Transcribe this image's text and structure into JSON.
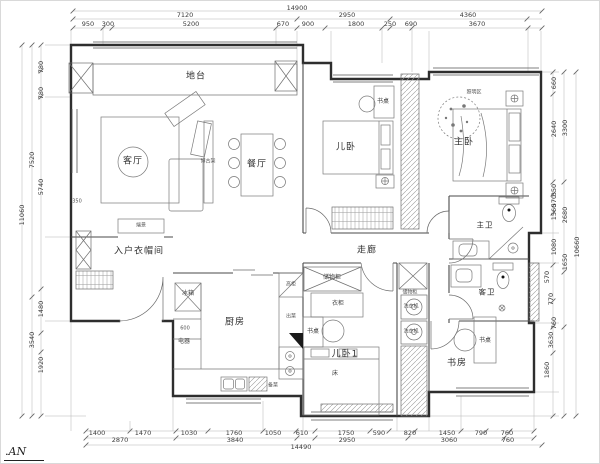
{
  "meta": {
    "drawing_type": "residential floor plan"
  },
  "footer": {
    "text": ".AN"
  },
  "colors": {
    "wall": "#2e2e2e",
    "partition": "#4a4a4a",
    "furniture": "#7a7a7a",
    "dim_line": "#b5b5b5",
    "dim_text": "#3a3a3a",
    "bg": "#ffffff"
  },
  "dimension_labels": {
    "top": [
      {
        "text": "14900",
        "x": 296,
        "y": 7
      },
      {
        "text": "7120",
        "x": 184,
        "y": 14
      },
      {
        "text": "2950",
        "x": 346,
        "y": 14
      },
      {
        "text": "4360",
        "x": 467,
        "y": 14
      },
      {
        "text": "950",
        "x": 87,
        "y": 23
      },
      {
        "text": "300",
        "x": 107,
        "y": 23
      },
      {
        "text": "5200",
        "x": 190,
        "y": 23
      },
      {
        "text": "670",
        "x": 282,
        "y": 23
      },
      {
        "text": "900",
        "x": 307,
        "y": 23
      },
      {
        "text": "1800",
        "x": 355,
        "y": 23
      },
      {
        "text": "250",
        "x": 389,
        "y": 23
      },
      {
        "text": "690",
        "x": 410,
        "y": 23
      },
      {
        "text": "3670",
        "x": 476,
        "y": 23
      }
    ],
    "bottom": [
      {
        "text": "1400",
        "x": 96,
        "y": 432
      },
      {
        "text": "1470",
        "x": 142,
        "y": 432
      },
      {
        "text": "1030",
        "x": 188,
        "y": 432
      },
      {
        "text": "1760",
        "x": 233,
        "y": 432
      },
      {
        "text": "1050",
        "x": 272,
        "y": 432
      },
      {
        "text": "610",
        "x": 301,
        "y": 432
      },
      {
        "text": "1750",
        "x": 345,
        "y": 432
      },
      {
        "text": "590",
        "x": 378,
        "y": 432
      },
      {
        "text": "820",
        "x": 409,
        "y": 432
      },
      {
        "text": "1450",
        "x": 446,
        "y": 432
      },
      {
        "text": "790",
        "x": 480,
        "y": 432
      },
      {
        "text": "760",
        "x": 506,
        "y": 432
      },
      {
        "text": "2870",
        "x": 119,
        "y": 439
      },
      {
        "text": "3840",
        "x": 234,
        "y": 439
      },
      {
        "text": "2950",
        "x": 346,
        "y": 439
      },
      {
        "text": "3060",
        "x": 448,
        "y": 439
      },
      {
        "text": "760",
        "x": 507,
        "y": 439
      },
      {
        "text": "14490",
        "x": 300,
        "y": 446
      }
    ],
    "left": [
      {
        "text": "780",
        "x": 40,
        "y": 66
      },
      {
        "text": "780",
        "x": 40,
        "y": 92
      },
      {
        "text": "7520",
        "x": 31,
        "y": 159
      },
      {
        "text": "5740",
        "x": 40,
        "y": 186
      },
      {
        "text": "11060",
        "x": 21,
        "y": 214
      },
      {
        "text": "1480",
        "x": 40,
        "y": 308
      },
      {
        "text": "3540",
        "x": 31,
        "y": 339
      },
      {
        "text": "1920",
        "x": 40,
        "y": 364
      }
    ],
    "right": [
      {
        "text": "660",
        "x": 553,
        "y": 82
      },
      {
        "text": "2640",
        "x": 553,
        "y": 128
      },
      {
        "text": "3300",
        "x": 564,
        "y": 127
      },
      {
        "text": "350",
        "x": 553,
        "y": 189
      },
      {
        "text": "570",
        "x": 553,
        "y": 200
      },
      {
        "text": "1560",
        "x": 553,
        "y": 211
      },
      {
        "text": "2680",
        "x": 564,
        "y": 214
      },
      {
        "text": "1080",
        "x": 553,
        "y": 246
      },
      {
        "text": "1650",
        "x": 564,
        "y": 261
      },
      {
        "text": "10660",
        "x": 576,
        "y": 246
      },
      {
        "text": "570",
        "x": 546,
        "y": 276
      },
      {
        "text": "770",
        "x": 550,
        "y": 298
      },
      {
        "text": "760",
        "x": 553,
        "y": 322
      },
      {
        "text": "3630",
        "x": 550,
        "y": 339
      },
      {
        "text": "1860",
        "x": 546,
        "y": 369
      }
    ]
  },
  "room_labels": [
    {
      "text": "地台",
      "x": 195,
      "y": 76,
      "size": "md"
    },
    {
      "text": "客厅",
      "x": 132,
      "y": 161,
      "size": "md"
    },
    {
      "text": "餐厅",
      "x": 256,
      "y": 164,
      "size": "md"
    },
    {
      "text": "博古架",
      "x": 207,
      "y": 161,
      "size": "xs"
    },
    {
      "text": "端景",
      "x": 140,
      "y": 225,
      "size": "xs"
    },
    {
      "text": "入户衣帽间",
      "x": 138,
      "y": 251,
      "size": "md"
    },
    {
      "text": "冰箱",
      "x": 187,
      "y": 293,
      "size": "sm"
    },
    {
      "text": "600",
      "x": 184,
      "y": 328,
      "size": "xs"
    },
    {
      "text": "电器",
      "x": 183,
      "y": 341,
      "size": "sm"
    },
    {
      "text": "厨房",
      "x": 234,
      "y": 322,
      "size": "md"
    },
    {
      "text": "高柜",
      "x": 290,
      "y": 284,
      "size": "xs"
    },
    {
      "text": "出菜",
      "x": 290,
      "y": 316,
      "size": "xs"
    },
    {
      "text": "备菜",
      "x": 272,
      "y": 385,
      "size": "xs"
    },
    {
      "text": "儿卧",
      "x": 345,
      "y": 147,
      "size": "md"
    },
    {
      "text": "书桌",
      "x": 382,
      "y": 101,
      "size": "sm"
    },
    {
      "text": "走廊",
      "x": 366,
      "y": 250,
      "size": "md"
    },
    {
      "text": "主卧",
      "x": 463,
      "y": 142,
      "size": "md"
    },
    {
      "text": "照明区",
      "x": 473,
      "y": 92,
      "size": "xs"
    },
    {
      "text": "主卫",
      "x": 484,
      "y": 224,
      "size": "rs"
    },
    {
      "text": "客卫",
      "x": 486,
      "y": 291,
      "size": "rs"
    },
    {
      "text": "储物柜",
      "x": 331,
      "y": 277,
      "size": "sm"
    },
    {
      "text": "衣柜",
      "x": 337,
      "y": 303,
      "size": "sm"
    },
    {
      "text": "书桌",
      "x": 312,
      "y": 331,
      "size": "sm"
    },
    {
      "text": "儿卧1",
      "x": 344,
      "y": 354,
      "size": "md"
    },
    {
      "text": "床",
      "x": 334,
      "y": 373,
      "size": "sm"
    },
    {
      "text": "储物柜",
      "x": 409,
      "y": 292,
      "size": "xs"
    },
    {
      "text": "洗衣机",
      "x": 410,
      "y": 306,
      "size": "xs"
    },
    {
      "text": "洗衣机",
      "x": 410,
      "y": 331,
      "size": "xs"
    },
    {
      "text": "书房",
      "x": 456,
      "y": 363,
      "size": "md"
    },
    {
      "text": "书桌",
      "x": 484,
      "y": 340,
      "size": "sm"
    },
    {
      "text": "350",
      "x": 76,
      "y": 201,
      "size": "xs"
    }
  ]
}
